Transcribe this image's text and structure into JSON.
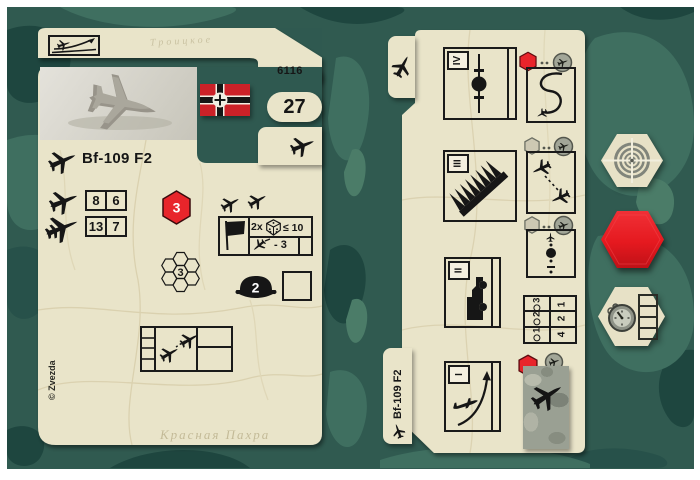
{
  "colors": {
    "card_beige": "#e9e4c9",
    "ink": "#161616",
    "order_red": "#e8252b",
    "flag_red": "#cc2128",
    "camo_base": "#305a50",
    "camo_light": "#3f6f60",
    "camo_dark": "#1e463f"
  },
  "left_card": {
    "catalog_number": "6116",
    "point_cost": "27",
    "unit_name": "Bf-109 F2",
    "combat_values": {
      "vs_fighter": [
        "8",
        "6"
      ],
      "vs_bomber": [
        "13",
        "7"
      ]
    },
    "order_hex_value": "3",
    "range_flower_value": "3",
    "flag_check": {
      "multiplier": "2x",
      "dice_roll": "≤ 10",
      "modifier": "- 3"
    },
    "pilot_value": "2",
    "copyright": "© Zvezda",
    "map_labels": [
      "Троицкое",
      "Красная Пахра"
    ]
  },
  "right_card": {
    "unit_name": "Bf-109 F2",
    "flight_levels": [
      "IV",
      "III",
      "II",
      "I"
    ],
    "speed_table": {
      "turn_headers": [
        "1",
        "2",
        "3"
      ],
      "speed_values": [
        "4",
        "2",
        "1"
      ]
    }
  }
}
